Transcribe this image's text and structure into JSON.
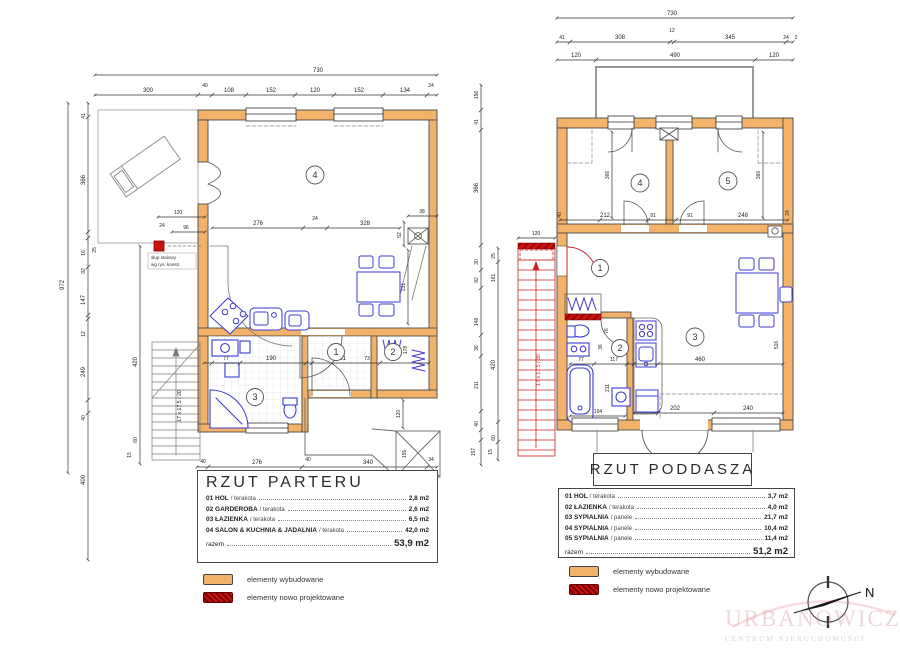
{
  "watermark": {
    "line1": "URBANOWICZ",
    "line2": "CENTRUM NIERUCHOMOŚCI"
  },
  "compass": {
    "north": "N"
  },
  "legend": {
    "built": "elementy wybudowane",
    "new": "elementy nowo projektowane",
    "built_color": "#f2b269",
    "new_color": "#cc1111"
  },
  "parter": {
    "title": "RZUT  PARTERU",
    "rows": [
      {
        "name": "01 HOL",
        "mat": "/ terakota",
        "area": "2,8 m2"
      },
      {
        "name": "02 GARDEROBA",
        "mat": "/ terakota",
        "area": "2,6 m2"
      },
      {
        "name": "03 ŁAZIENKA",
        "mat": "/ terakota",
        "area": "6,5 m2"
      },
      {
        "name": "04 SALON & KUCHNIA & JADALNIA",
        "mat": "/ terakota",
        "area": "42,0 m2"
      }
    ],
    "razem": "razem",
    "total": "53,9 m2",
    "rooms": [
      "1",
      "2",
      "3",
      "4"
    ],
    "stairs": "17 x 17,5 / 20",
    "column_note1": "słup stalowy",
    "column_note2": "wg rys. konstr.",
    "dims": {
      "top": [
        "730",
        "300",
        "40",
        "108",
        "152",
        "120",
        "152",
        "134",
        "24"
      ],
      "left": [
        "972",
        "41",
        "366",
        "16",
        "92",
        "147",
        "12",
        "249",
        "40",
        "400",
        "25",
        "420",
        "60",
        "15"
      ],
      "inner": [
        "276",
        "24",
        "328",
        "38",
        "52",
        "231",
        "77",
        "190",
        "101",
        "73",
        "178",
        "120",
        "24",
        "96",
        "40",
        "340",
        "155",
        "34",
        "120",
        "276",
        "40"
      ]
    }
  },
  "poddasze": {
    "title": "RZUT  PODDASZA",
    "rows": [
      {
        "name": "01 HOL",
        "mat": "/ terakota",
        "area": "3,7 m2"
      },
      {
        "name": "02 ŁAZIENKA",
        "mat": "/ terakota",
        "area": "4,0 m2"
      },
      {
        "name": "03 SYPIALNIA",
        "mat": "/ panele",
        "area": "21,7 m2"
      },
      {
        "name": "04 SYPIALNIA",
        "mat": "/ panele",
        "area": "10,4 m2"
      },
      {
        "name": "05 SYPIALNIA",
        "mat": "/ panele",
        "area": "11,4 m2"
      }
    ],
    "razem": "razem",
    "total": "51,2 m2",
    "rooms": [
      "1",
      "2",
      "3",
      "4",
      "5"
    ],
    "stairs": "17 x 17,5 / 30",
    "dims": {
      "top": [
        "730",
        "12",
        "41",
        "308",
        "345",
        "24",
        "2",
        "120",
        "490",
        "120"
      ],
      "left": [
        "156",
        "41",
        "366",
        "30",
        "92",
        "148",
        "36",
        "211",
        "40",
        "157",
        "25",
        "161",
        "420",
        "60",
        "15",
        "120"
      ],
      "inner": [
        "212",
        "91",
        "91",
        "248",
        "366",
        "366",
        "24",
        "76",
        "36",
        "117",
        "211",
        "194",
        "77",
        "460",
        "516",
        "202",
        "240",
        "40"
      ]
    }
  }
}
